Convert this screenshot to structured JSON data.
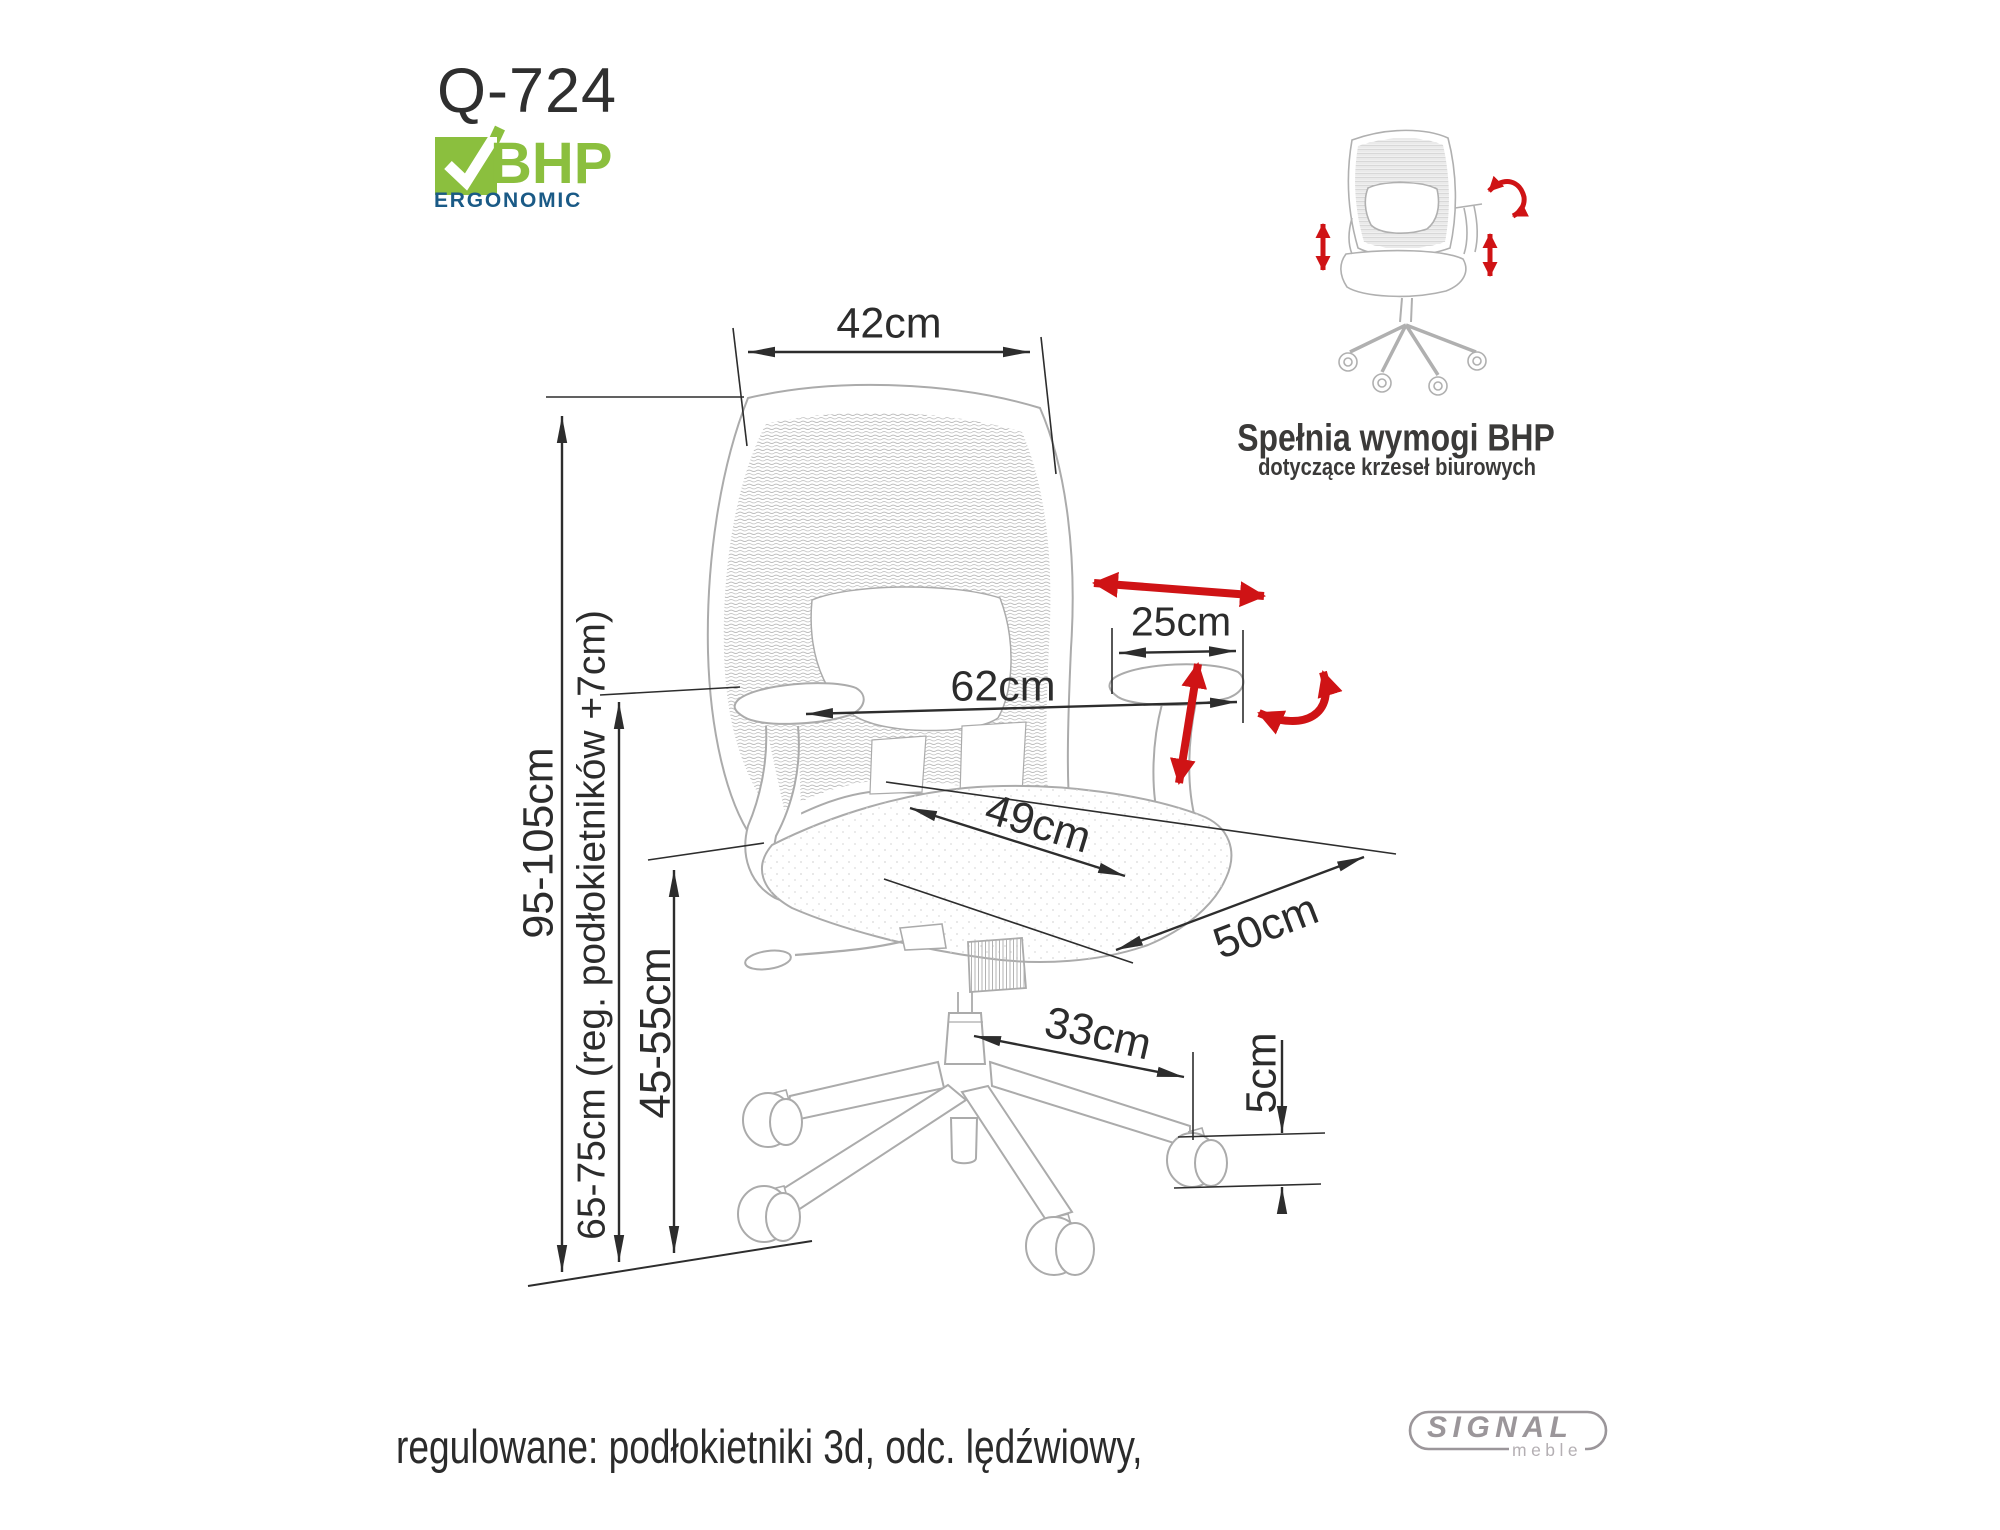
{
  "product": {
    "code": "Q-724"
  },
  "bhp_badge": {
    "name": "BHP",
    "subtitle": "ERGONOMIC"
  },
  "compliance": {
    "title": "Spełnia wymogi BHP",
    "subtitle": "dotyczące krzeseł biurowych"
  },
  "dimensions": {
    "backrest_width": "42cm",
    "total_height": "95-105cm",
    "armrest_height": "65-75cm (reg. podłokietników +7cm)",
    "seat_height": "45-55cm",
    "overall_width": "62cm",
    "armrest_pad_length": "25cm",
    "seat_width": "49cm",
    "seat_depth": "50cm",
    "base_leg_reach": "33cm",
    "caster_height": "5cm"
  },
  "caption": "regulowane: podłokietniki 3d, odc. lędźwiowy,",
  "brand": {
    "name": "SIGNAL",
    "subtitle": "meble"
  },
  "colors": {
    "accent_red": "#cf1315",
    "bhp_green": "#8bbf3e",
    "bhp_blue": "#1a5a86",
    "brand_gray": "#9b969a",
    "dimension_line": "#2d2d2d",
    "artwork_gray": "#ababab"
  }
}
